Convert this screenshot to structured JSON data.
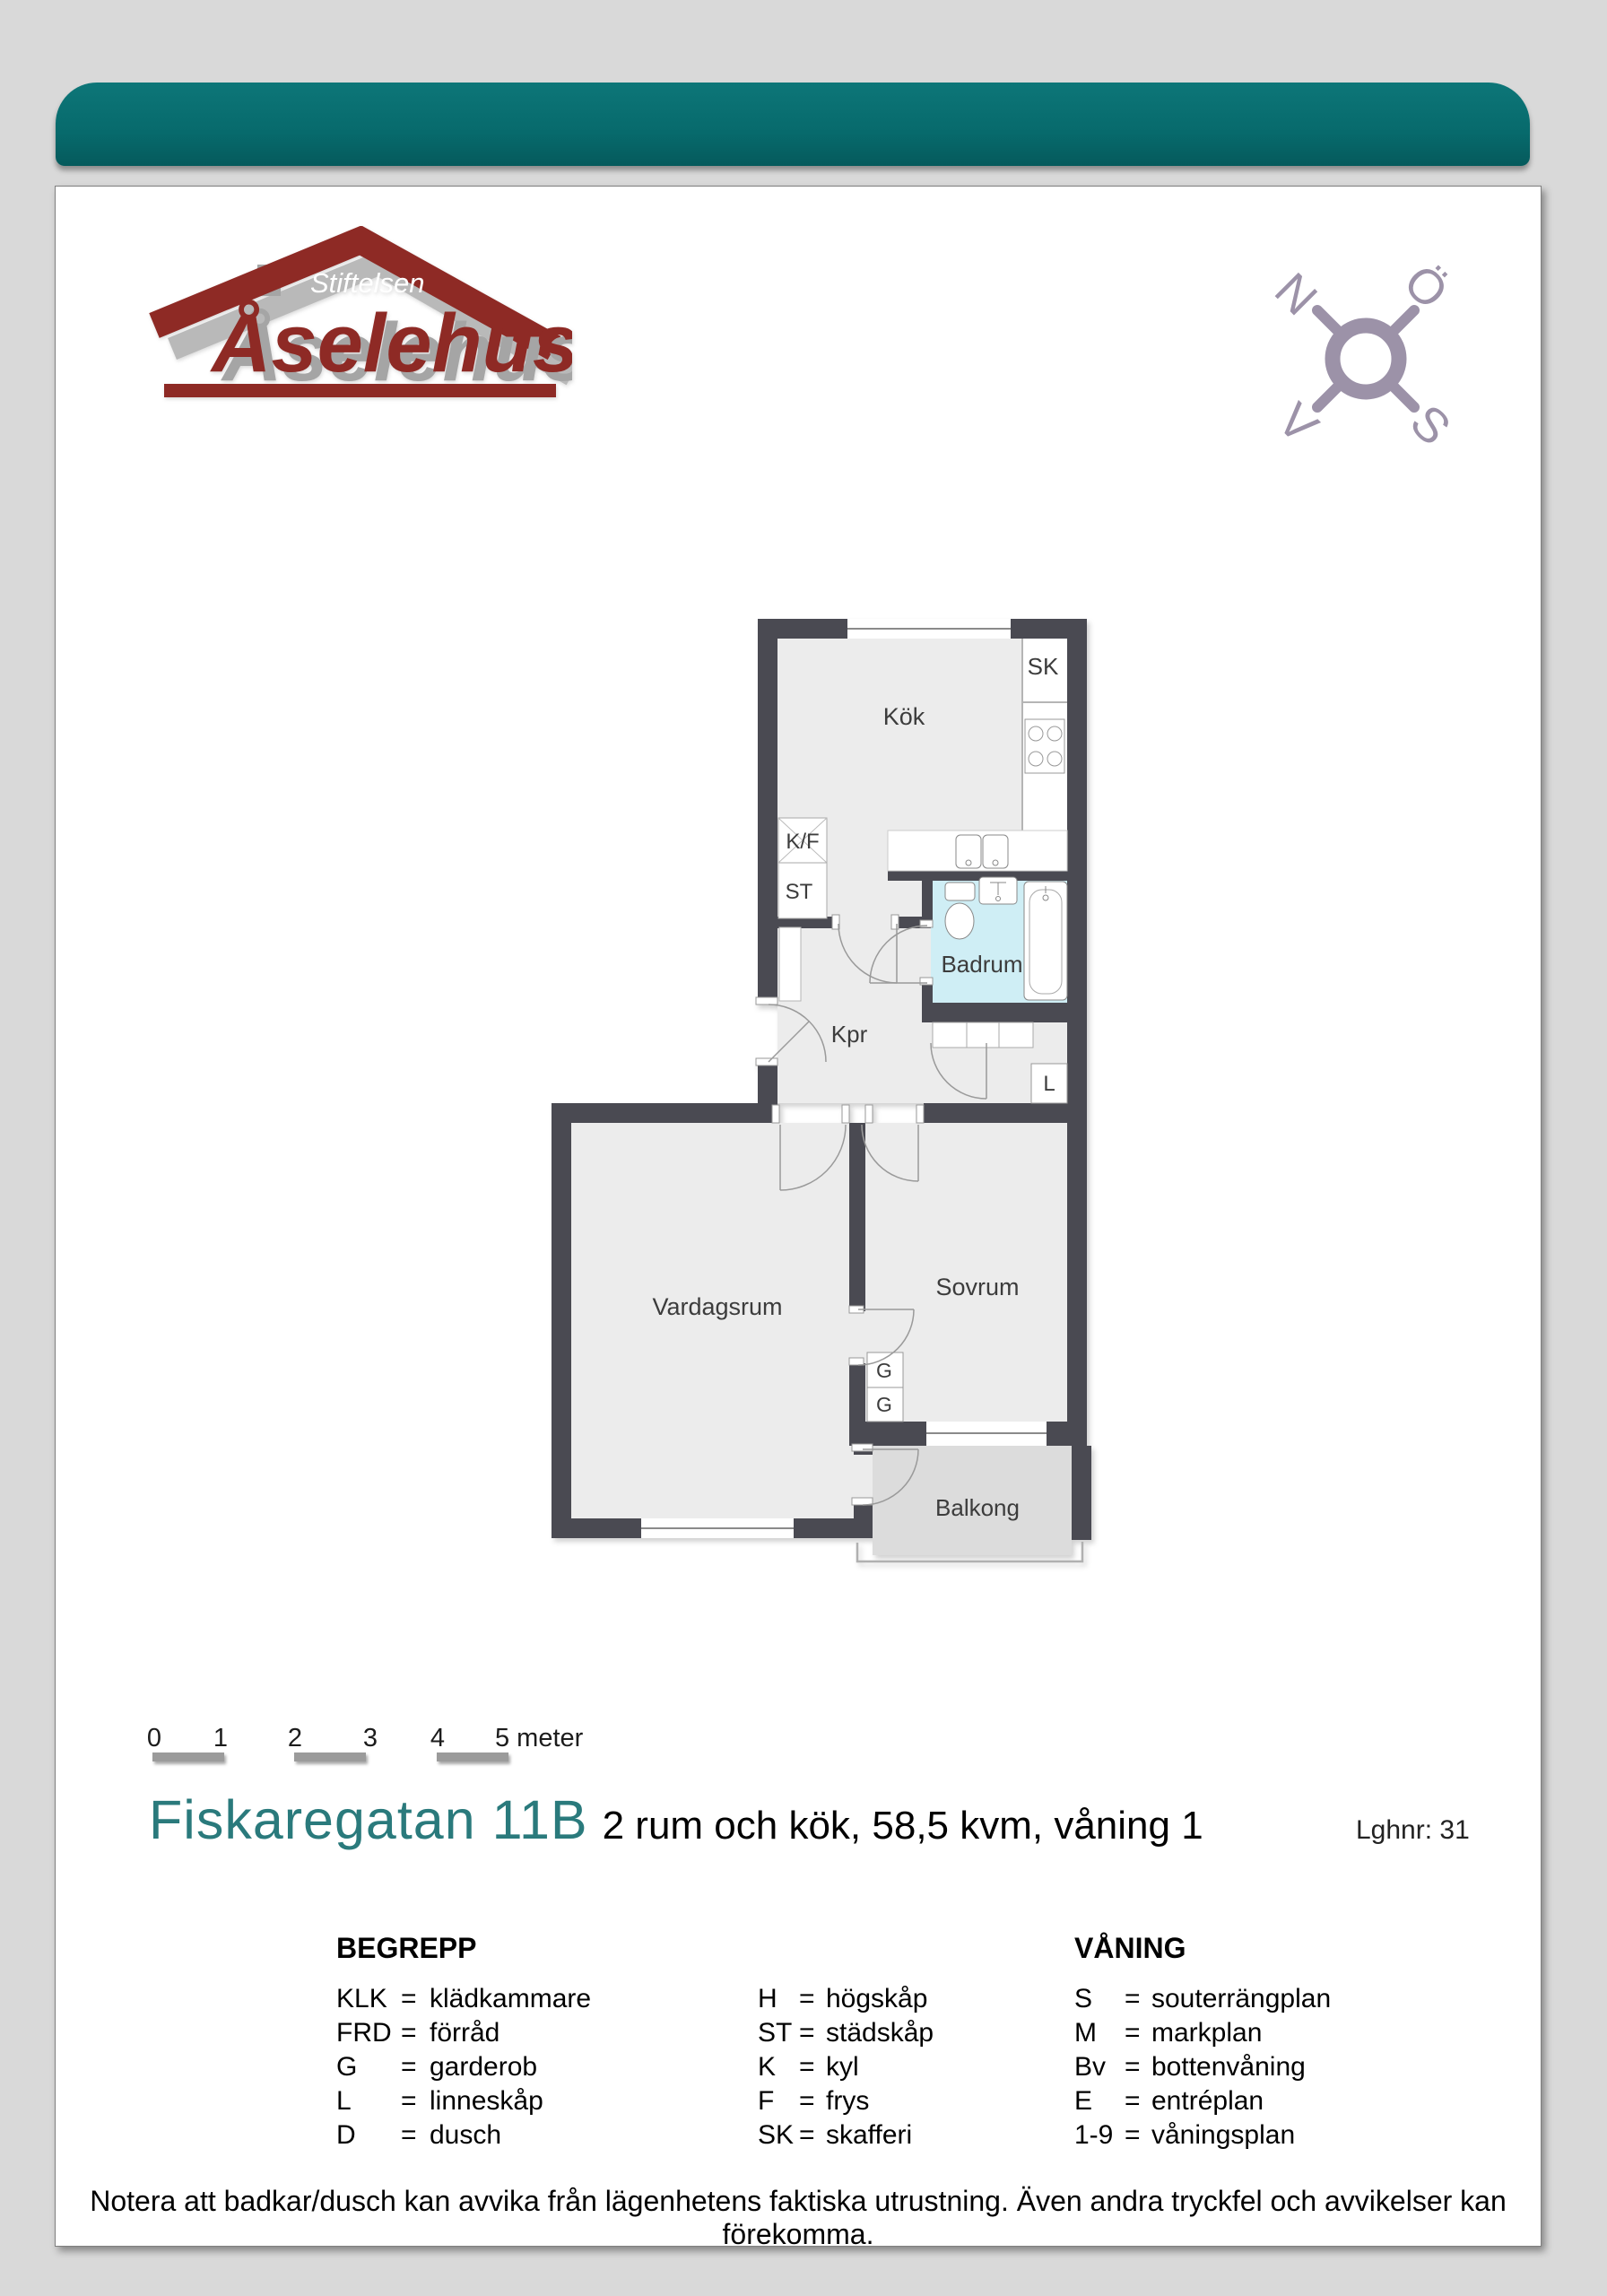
{
  "colors": {
    "header_bar": "#076a6c",
    "title_accent": "#2a7a7c",
    "logo_red": "#8e2a25",
    "compass_purple": "#9c92a8",
    "wall": "#4a4a52",
    "floor": "#ececec",
    "bath_floor": "#cfeef5",
    "balcony_floor": "#dcdcdc"
  },
  "logo": {
    "stiftelsen": "Stiftelsen",
    "aselehus": "Åselehus"
  },
  "compass": {
    "north": "N",
    "east": "Ö",
    "south": "S",
    "west": "V"
  },
  "plan": {
    "rooms": {
      "kok": "Kök",
      "badrum": "Badrum",
      "kpr": "Kpr",
      "sovrum": "Sovrum",
      "vardagsrum": "Vardagsrum",
      "balkong": "Balkong"
    },
    "closets": {
      "sk": "SK",
      "kf": "K/F",
      "st": "ST",
      "l": "L",
      "g1": "G",
      "g2": "G"
    }
  },
  "scalebar": {
    "ticks": [
      "0",
      "1",
      "2",
      "3",
      "4"
    ],
    "end_label": "5 meter"
  },
  "title": {
    "address": "Fiskaregatan 11B",
    "details": "2 rum och kök, 58,5 kvm, våning 1",
    "apartment_no": "Lghnr: 31"
  },
  "legend": {
    "begrepp": {
      "heading": "BEGREPP",
      "items": [
        {
          "abbr": "KLK",
          "eq": "=",
          "text": "klädkammare"
        },
        {
          "abbr": "FRD",
          "eq": "=",
          "text": "förråd"
        },
        {
          "abbr": "G",
          "eq": "=",
          "text": "garderob"
        },
        {
          "abbr": "L",
          "eq": "=",
          "text": "linneskåp"
        },
        {
          "abbr": "D",
          "eq": "=",
          "text": "dusch"
        }
      ]
    },
    "skap": {
      "items": [
        {
          "abbr": "H",
          "eq": "=",
          "text": "högskåp"
        },
        {
          "abbr": "ST",
          "eq": "=",
          "text": "städskåp"
        },
        {
          "abbr": "K",
          "eq": "=",
          "text": "kyl"
        },
        {
          "abbr": "F",
          "eq": "=",
          "text": "frys"
        },
        {
          "abbr": "SK",
          "eq": "=",
          "text": "skafferi"
        }
      ]
    },
    "vaning": {
      "heading": "VÅNING",
      "items": [
        {
          "abbr": "S",
          "eq": "=",
          "text": "souterrängplan"
        },
        {
          "abbr": "M",
          "eq": "=",
          "text": "markplan"
        },
        {
          "abbr": "Bv",
          "eq": "=",
          "text": "bottenvåning"
        },
        {
          "abbr": "E",
          "eq": "=",
          "text": "entréplan"
        },
        {
          "abbr": "1-9",
          "eq": "=",
          "text": "våningsplan"
        }
      ]
    }
  },
  "footer": {
    "note": "Notera att badkar/dusch kan avvika från lägenhetens faktiska utrustning. Även andra tryckfel och avvikelser kan förekomma."
  }
}
